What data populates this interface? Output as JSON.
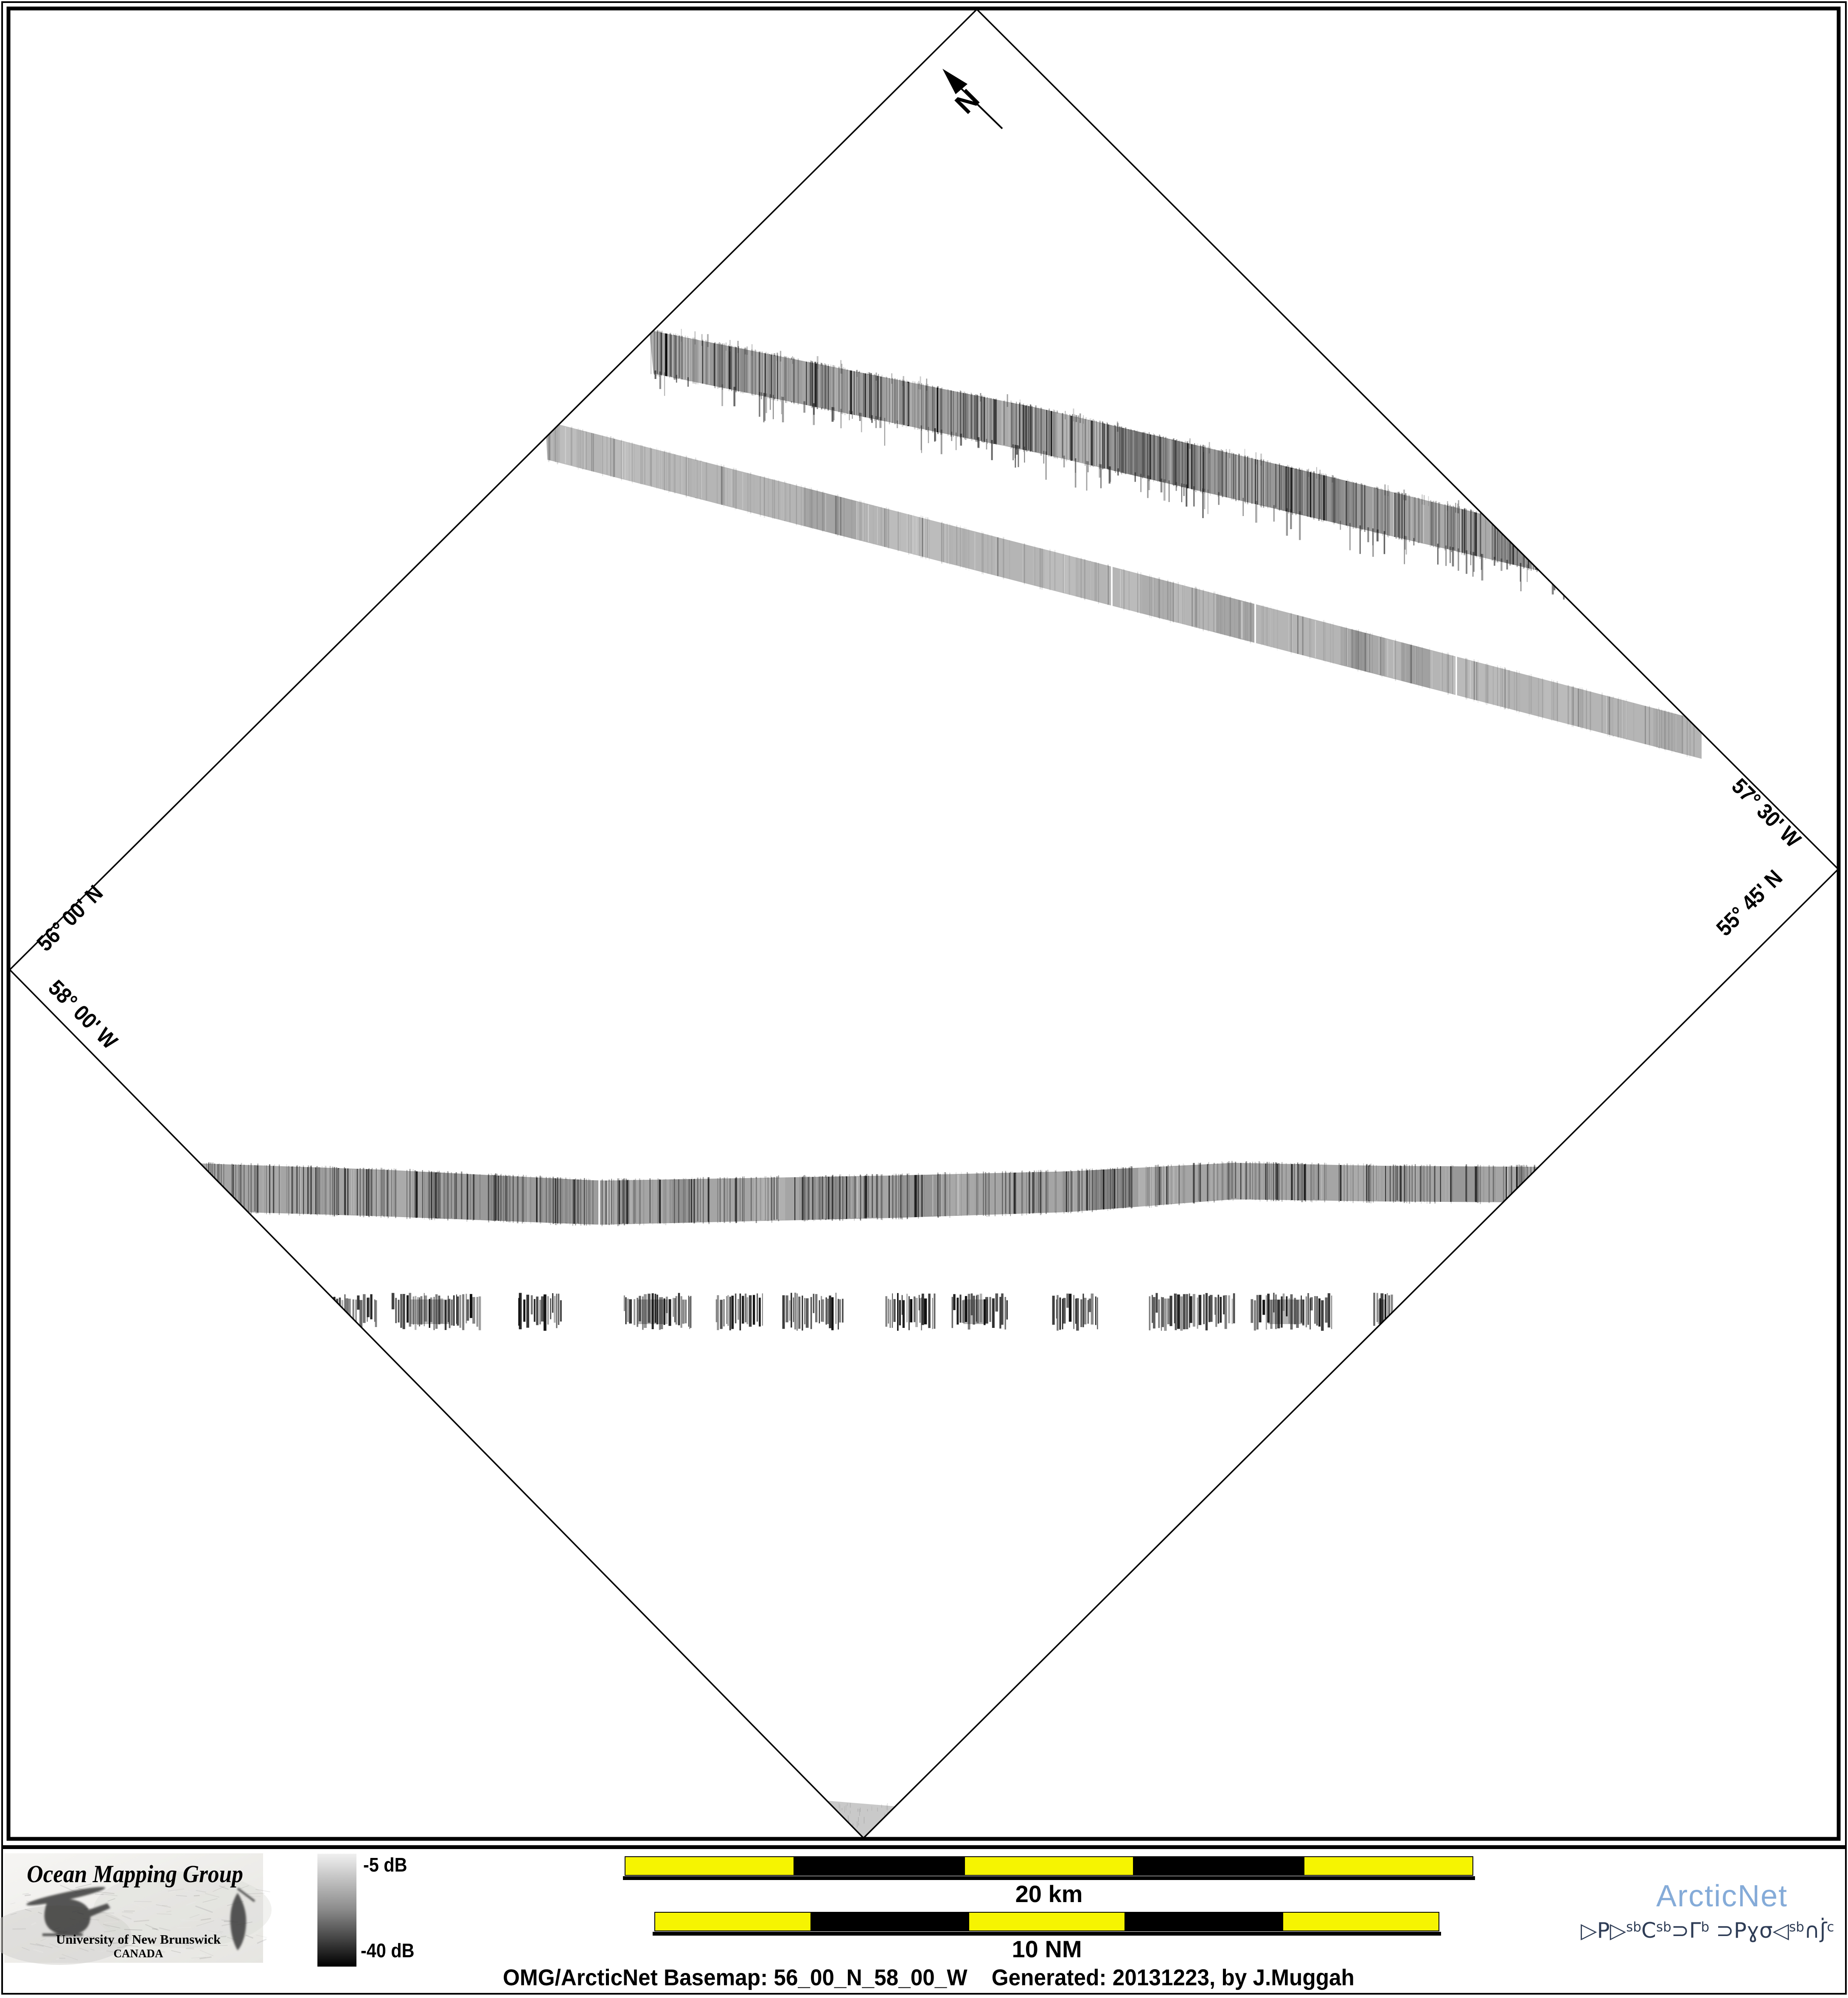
{
  "page": {
    "generator_caption": {
      "left": "OMG/ArcticNet Basemap: 56_00_N_58_00_W",
      "right": "Generated: 20131223, by J.Muggah"
    }
  },
  "map": {
    "north_label": "N",
    "graticule_labels": {
      "top_left": "56° 00' N",
      "bottom_left": "58° 00' W",
      "top_right": "57° 30' W",
      "bottom_right": "55° 45' N"
    },
    "swaths": [
      {
        "name": "upper ragged backscatter swath"
      },
      {
        "name": "upper smooth backscatter swath"
      },
      {
        "name": "middle horizontal backscatter swath"
      },
      {
        "name": "dashed dark backscatter segment row"
      },
      {
        "name": "bottom vertex swath fragment"
      }
    ]
  },
  "legend": {
    "top_label": "-5 dB",
    "bottom_label": "-40 dB"
  },
  "scale_bars": {
    "km": {
      "label": "20 km"
    },
    "nm": {
      "label": "10 NM"
    }
  },
  "footer": {
    "omg_logo": {
      "title": "Ocean Mapping Group",
      "subtitle": "University of New Brunswick",
      "country": "CANADA"
    },
    "arcticnet": {
      "name": "ArcticNet",
      "syllabics": "ᐅᑭᐅᖅᑕᖅᑐᒥᒃ ᑐᑭᓯᓂᐊᖃᑎᒌᑦ",
      "parts": [
        "▷P▷",
        "sb",
        "C",
        "sb",
        "⊃Γ",
        "b",
        " ⊃Pɣσ◁",
        "sb",
        "∩ʃ̇",
        "c"
      ]
    }
  },
  "colors": {
    "scale_yellow": "#f6f400",
    "omg_red": "#a11212",
    "unb_blue": "#2a2aa8",
    "arcticnet_blue": "#85abd8",
    "syllabics_navy": "#2e3d55"
  }
}
